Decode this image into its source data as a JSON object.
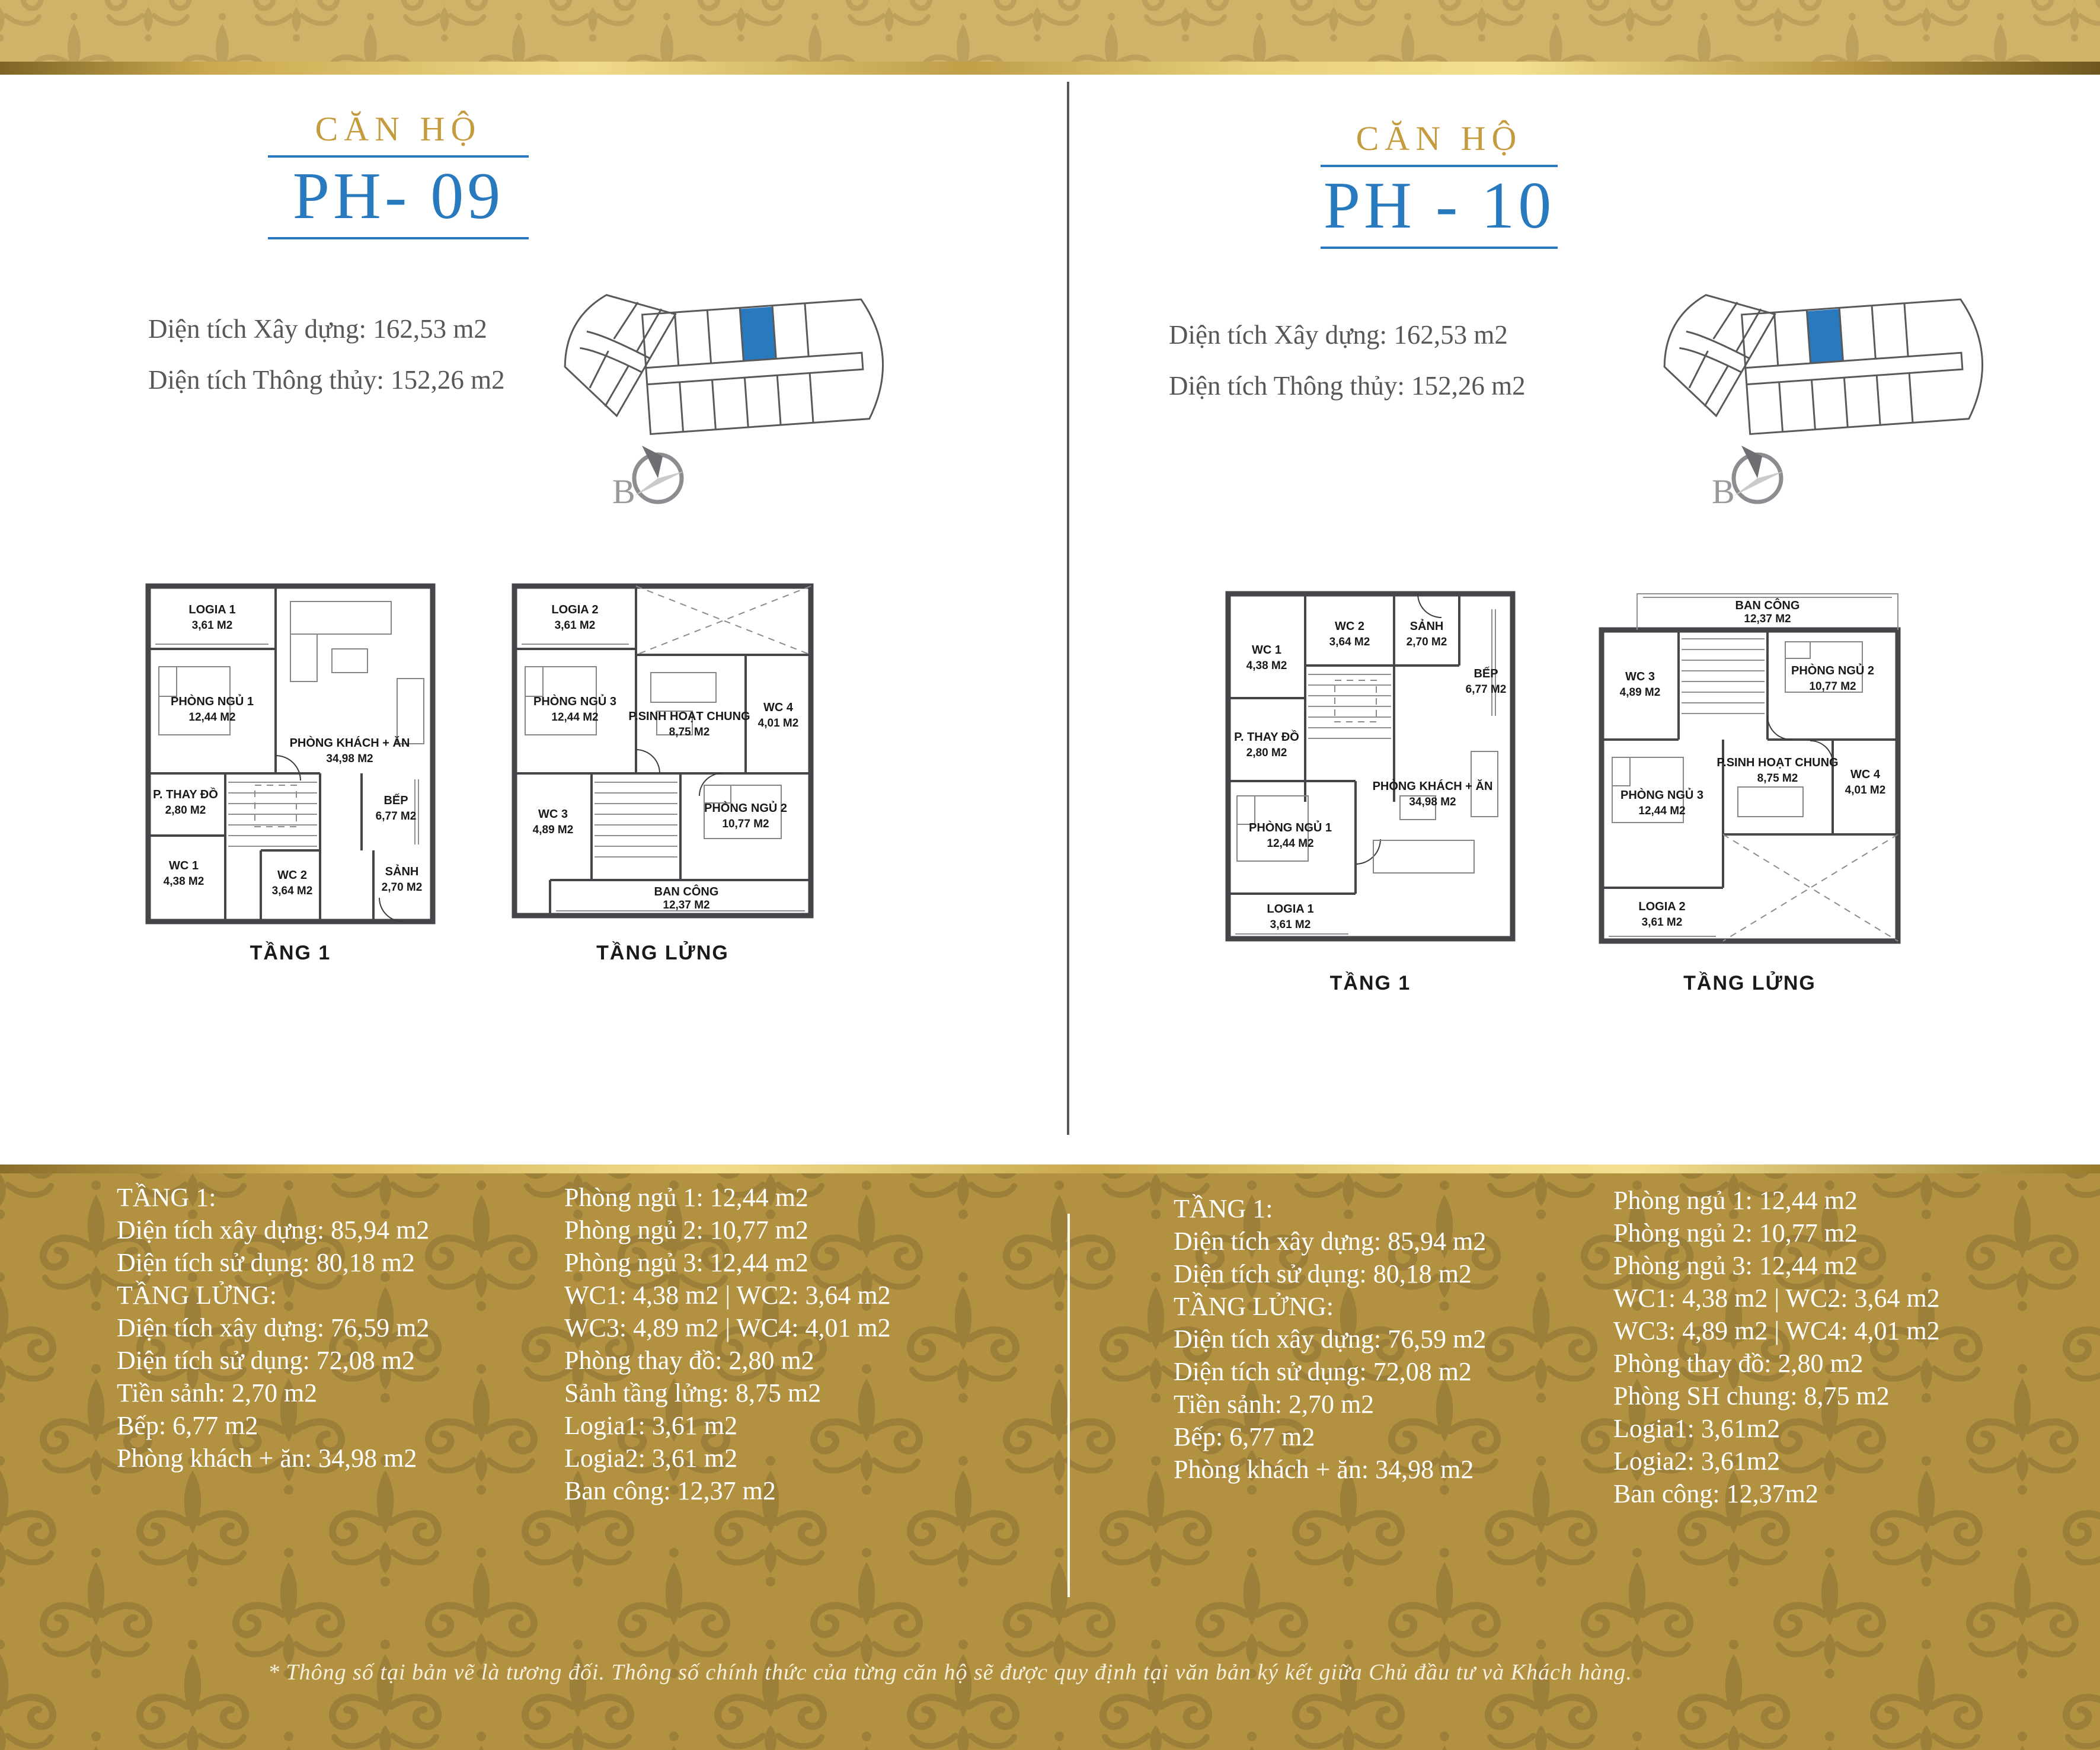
{
  "page": {
    "footnote": "* Thông số tại bản vẽ là tương đối. Thông số chính thức của từng căn hộ sẽ được quy định tại văn bản ký kết giữa Chủ đầu tư và Khách hàng.",
    "colors": {
      "accent_gold": "#c49b3d",
      "accent_blue": "#2879bd",
      "unit_highlight": "#2879bd",
      "band_gold_base": "#d2b268",
      "band_gold_motif": "#bda05c",
      "panel_gold_base": "#b29140",
      "panel_gold_motif": "#9c7f38",
      "area_text_gray": "#57575a",
      "list_text_white": "#ffffff"
    }
  },
  "units": [
    {
      "id": "ph09",
      "title_label": "CĂN HỘ",
      "code": "PH- 09",
      "area_built": "Diện tích Xây dựng: 162,53 m2",
      "area_net": "Diện tích Thông thủy: 152,26 m2",
      "compass": "B",
      "plan1": {
        "caption": "TẦNG 1",
        "rooms": {
          "logia": {
            "name": "LOGIA 1",
            "area": "3,61 M2"
          },
          "bed1": {
            "name": "PHÒNG NGỦ 1",
            "area": "12,44 M2"
          },
          "living": {
            "name": "PHÒNG KHÁCH + ĂN",
            "area": "34,98 M2"
          },
          "dress": {
            "name": "P. THAY ĐỒ",
            "area": "2,80 M2"
          },
          "wc1": {
            "name": "WC 1",
            "area": "4,38 M2"
          },
          "wc2": {
            "name": "WC 2",
            "area": "3,64 M2"
          },
          "hall": {
            "name": "SẢNH",
            "area": "2,70 M2"
          },
          "kitchen": {
            "name": "BẾP",
            "area": "6,77 M2"
          }
        }
      },
      "plan2": {
        "caption": "TẦNG LỬNG",
        "rooms": {
          "logia": {
            "name": "LOGIA 2",
            "area": "3,61 M2"
          },
          "bed3": {
            "name": "PHÒNG NGỦ 3",
            "area": "12,44 M2"
          },
          "family": {
            "name": "P.SINH HOẠT CHUNG",
            "area": "8,75 M2"
          },
          "wc4": {
            "name": "WC 4",
            "area": "4,01 M2"
          },
          "wc3": {
            "name": "WC 3",
            "area": "4,89 M2"
          },
          "bed2": {
            "name": "PHÒNG NGỦ 2",
            "area": "10,77 M2"
          },
          "balcony": {
            "name": "BAN CÔNG",
            "area": "12,37 M2"
          }
        }
      },
      "specs_col1": [
        "TẦNG 1:",
        "Diện tích xây dựng: 85,94 m2",
        "Diện tích sử dụng: 80,18 m2",
        "TẦNG LỬNG:",
        "Diện tích xây dựng: 76,59 m2",
        "Diện tích sử dụng: 72,08 m2",
        "Tiền sảnh: 2,70 m2",
        "Bếp: 6,77 m2",
        "Phòng khách + ăn: 34,98 m2"
      ],
      "specs_col2": [
        "Phòng ngủ 1: 12,44 m2",
        "Phòng ngủ 2: 10,77 m2",
        "Phòng ngủ 3: 12,44 m2",
        "WC1: 4,38 m2   |   WC2: 3,64 m2",
        "WC3: 4,89 m2   |   WC4: 4,01 m2",
        "Phòng thay đồ: 2,80 m2",
        "Sảnh tầng lửng: 8,75 m2",
        "Logia1: 3,61 m2",
        "Logia2: 3,61 m2",
        "Ban công: 12,37 m2"
      ]
    },
    {
      "id": "ph10",
      "title_label": "CĂN HỘ",
      "code": "PH - 10",
      "area_built": "Diện tích Xây dựng: 162,53 m2",
      "area_net": "Diện tích Thông thủy: 152,26 m2",
      "compass": "B",
      "plan1": {
        "caption": "TẦNG 1",
        "rooms": {
          "wc1": {
            "name": "WC 1",
            "area": "4,38 M2"
          },
          "wc2": {
            "name": "WC 2",
            "area": "3,64 M2"
          },
          "hall": {
            "name": "SẢNH",
            "area": "2,70 M2"
          },
          "kitchen": {
            "name": "BẾP",
            "area": "6,77 M2"
          },
          "dress": {
            "name": "P. THAY ĐỒ",
            "area": "2,80 M2"
          },
          "bed1": {
            "name": "PHÒNG NGỦ 1",
            "area": "12,44 M2"
          },
          "living": {
            "name": "PHÒNG KHÁCH + ĂN",
            "area": "34,98 M2"
          },
          "logia": {
            "name": "LOGIA 1",
            "area": "3,61 M2"
          }
        }
      },
      "plan2": {
        "caption": "TẦNG LỬNG",
        "rooms": {
          "balcony": {
            "name": "BAN CÔNG",
            "area": "12,37 M2"
          },
          "wc3": {
            "name": "WC 3",
            "area": "4,89 M2"
          },
          "bed2": {
            "name": "PHÒNG NGỦ 2",
            "area": "10,77 M2"
          },
          "family": {
            "name": "P.SINH HOẠT CHUNG",
            "area": "8,75 M2"
          },
          "wc4": {
            "name": "WC 4",
            "area": "4,01 M2"
          },
          "bed3": {
            "name": "PHÒNG NGỦ 3",
            "area": "12,44 M2"
          },
          "logia": {
            "name": "LOGIA 2",
            "area": "3,61 M2"
          }
        }
      },
      "specs_col1": [
        "TẦNG 1:",
        "Diện tích xây dựng: 85,94 m2",
        "Diện tích sử dụng: 80,18 m2",
        "TẦNG LỬNG:",
        "Diện tích xây dựng: 76,59 m2",
        "Diện tích sử dụng: 72,08 m2",
        "Tiền sảnh: 2,70 m2",
        "Bếp: 6,77 m2",
        "Phòng khách + ăn: 34,98 m2"
      ],
      "specs_col2": [
        "Phòng ngủ 1: 12,44 m2",
        "Phòng ngủ 2: 10,77 m2",
        "Phòng ngủ 3: 12,44 m2",
        "WC1: 4,38 m2   |   WC2: 3,64 m2",
        "WC3: 4,89 m2   |   WC4: 4,01 m2",
        "Phòng thay đồ: 2,80 m2",
        "Phòng SH chung: 8,75 m2",
        "Logia1: 3,61m2",
        "Logia2: 3,61m2",
        "Ban công: 12,37m2"
      ]
    }
  ]
}
